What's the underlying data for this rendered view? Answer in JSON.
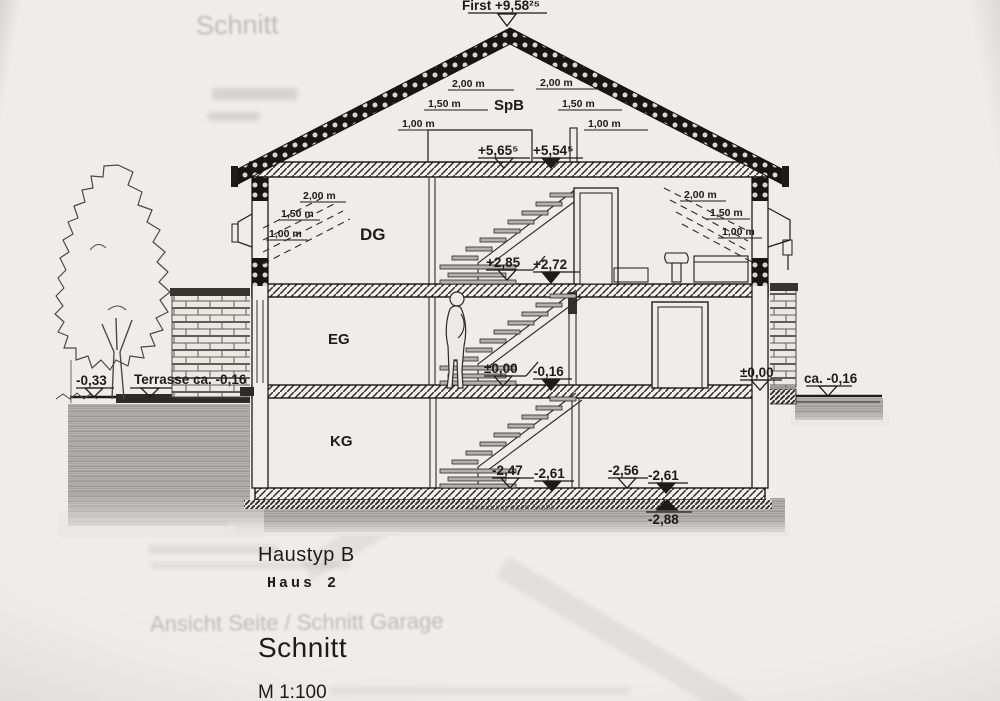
{
  "title_block": {
    "haustyp": "Haustyp B",
    "haus_nr": "Haus 2",
    "drawing_title": "Schnitt",
    "scale": "M 1:100"
  },
  "rooms": {
    "spb": "SpB",
    "dg": "DG",
    "eg": "EG",
    "kg": "KG"
  },
  "ridge_label": "First +9,58²⁵",
  "levels": {
    "dg_ceiling_top": "+5,65⁵",
    "dg_ceiling_slab": "+5,54⁵",
    "dg_floor_top": "+2,85",
    "dg_floor_slab": "+2,72",
    "eg_floor_top": "±0,00",
    "eg_floor_slab": "-0,16",
    "kg_floor_top_left": "-2,47",
    "kg_floor_slab_left": "-2,61",
    "kg_floor_top_right": "-2,56",
    "kg_floor_slab_right": "-2,61",
    "foundation_bottom": "-2,88",
    "terrain_left": "-0,33",
    "terrace": "Terrasse ca. -0,16",
    "terrain_right_top": "±0,00",
    "terrain_right": "ca. -0,16"
  },
  "clearance_heights": [
    "2,00 m",
    "1,50 m",
    "1,00 m"
  ],
  "notes": {
    "foundation": "Gründung nach Statik"
  },
  "ghost_text": {
    "top": "Schnitt",
    "bottom": "Ansicht Seite / Schnitt Garage"
  },
  "colors": {
    "ink": "#1d1c1a",
    "paper": "#efede9",
    "soil": "#b4b2ae"
  }
}
